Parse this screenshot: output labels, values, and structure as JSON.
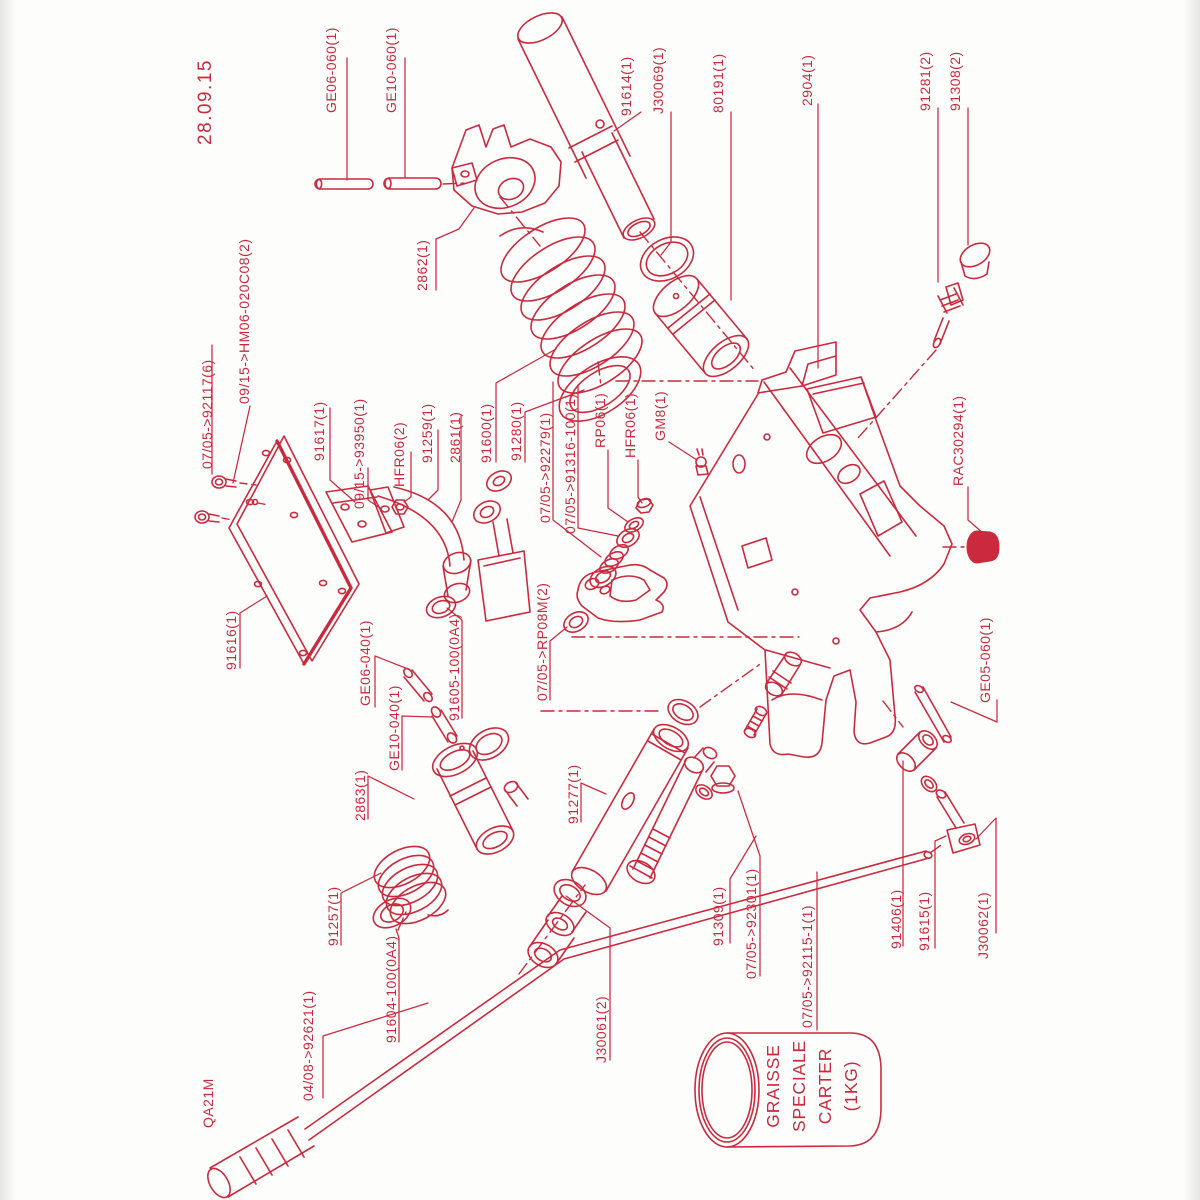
{
  "doc": {
    "type": "exploded-parts-diagram",
    "accent_color": "#cb2a3e",
    "background_color": "#fdfdfb",
    "date": "28.09.15"
  },
  "diagram": {
    "labels": [
      {
        "id": "date",
        "text": "28.09.15",
        "x": 197,
        "y": 145,
        "size": 19
      },
      {
        "id": "ge06-060",
        "text": "GE06-060(1)",
        "x": 323,
        "y": 113
      },
      {
        "id": "ge10-060",
        "text": "GE10-060(1)",
        "x": 383,
        "y": 113
      },
      {
        "id": "2862",
        "text": "2862(1)",
        "x": 414,
        "y": 291
      },
      {
        "id": "91614",
        "text": "91614(1)",
        "x": 618,
        "y": 116
      },
      {
        "id": "j30069",
        "text": "J30069(1)",
        "x": 650,
        "y": 114
      },
      {
        "id": "80191",
        "text": "80191(1)",
        "x": 710,
        "y": 113
      },
      {
        "id": "2904",
        "text": "2904(1)",
        "x": 799,
        "y": 106
      },
      {
        "id": "91281",
        "text": "91281(2)",
        "x": 917,
        "y": 111
      },
      {
        "id": "91308",
        "text": "91308(2)",
        "x": 947,
        "y": 111
      },
      {
        "id": "92117",
        "text": "07/05->92117(6)",
        "x": 199,
        "y": 469
      },
      {
        "id": "hm06",
        "text": "09/15->HM06-020C08(2)",
        "x": 236,
        "y": 404
      },
      {
        "id": "91617",
        "text": "91617(1)",
        "x": 311,
        "y": 461
      },
      {
        "id": "93950",
        "text": "09/15->93950(1)",
        "x": 351,
        "y": 509
      },
      {
        "id": "hfr06-2",
        "text": "HFR06(2)",
        "x": 391,
        "y": 487
      },
      {
        "id": "91259",
        "text": "91259(1)",
        "x": 419,
        "y": 463
      },
      {
        "id": "2861",
        "text": "2861(1)",
        "x": 447,
        "y": 463
      },
      {
        "id": "91600",
        "text": "91600(1)",
        "x": 478,
        "y": 463
      },
      {
        "id": "91280",
        "text": "91280(1)",
        "x": 508,
        "y": 461
      },
      {
        "id": "92279",
        "text": "07/05->92279(1)",
        "x": 537,
        "y": 523
      },
      {
        "id": "91316",
        "text": "07/05->91316-100(1)",
        "x": 562,
        "y": 534
      },
      {
        "id": "rp06",
        "text": "RP06(1)",
        "x": 592,
        "y": 448
      },
      {
        "id": "hfr06-1",
        "text": "HFR06(1)",
        "x": 622,
        "y": 458
      },
      {
        "id": "gm8",
        "text": "GM8(1)",
        "x": 652,
        "y": 441
      },
      {
        "id": "rac30294",
        "text": "RAC30294(1)",
        "x": 950,
        "y": 486
      },
      {
        "id": "91616",
        "text": "91616(1)",
        "x": 223,
        "y": 670
      },
      {
        "id": "ge06-040",
        "text": "GE06-040(1)",
        "x": 357,
        "y": 706
      },
      {
        "id": "ge10-040",
        "text": "GE10-040(1)",
        "x": 386,
        "y": 771
      },
      {
        "id": "91605",
        "text": "91605-100(0A4)",
        "x": 446,
        "y": 721
      },
      {
        "id": "rp08m",
        "text": "07/05->RP08M(2)",
        "x": 534,
        "y": 701
      },
      {
        "id": "2863",
        "text": "2863(1)",
        "x": 352,
        "y": 821
      },
      {
        "id": "91277",
        "text": "91277(1)",
        "x": 565,
        "y": 824
      },
      {
        "id": "ge05-060",
        "text": "GE05-060(1)",
        "x": 977,
        "y": 703
      },
      {
        "id": "91257",
        "text": "91257(1)",
        "x": 325,
        "y": 946
      },
      {
        "id": "91604",
        "text": "91604-100(0A4)",
        "x": 383,
        "y": 1043
      },
      {
        "id": "92621",
        "text": "04/08->92621(1)",
        "x": 300,
        "y": 1101
      },
      {
        "id": "qa21m",
        "text": "QA21M",
        "x": 200,
        "y": 1128
      },
      {
        "id": "j30061",
        "text": "J30061(2)",
        "x": 593,
        "y": 1063
      },
      {
        "id": "91309",
        "text": "91309(1)",
        "x": 710,
        "y": 946
      },
      {
        "id": "92301",
        "text": "07/05->92301(1)",
        "x": 743,
        "y": 979
      },
      {
        "id": "92115",
        "text": "07/05->92115-1(1)",
        "x": 799,
        "y": 1028
      },
      {
        "id": "91406",
        "text": "91406(1)",
        "x": 888,
        "y": 949
      },
      {
        "id": "91615",
        "text": "91615(1)",
        "x": 916,
        "y": 951
      },
      {
        "id": "j30062",
        "text": "J30062(1)",
        "x": 975,
        "y": 959
      }
    ],
    "grease_can": {
      "lines": [
        "GRAISSE",
        "SPECIALE",
        "CARTER",
        "(1KG)"
      ]
    }
  }
}
